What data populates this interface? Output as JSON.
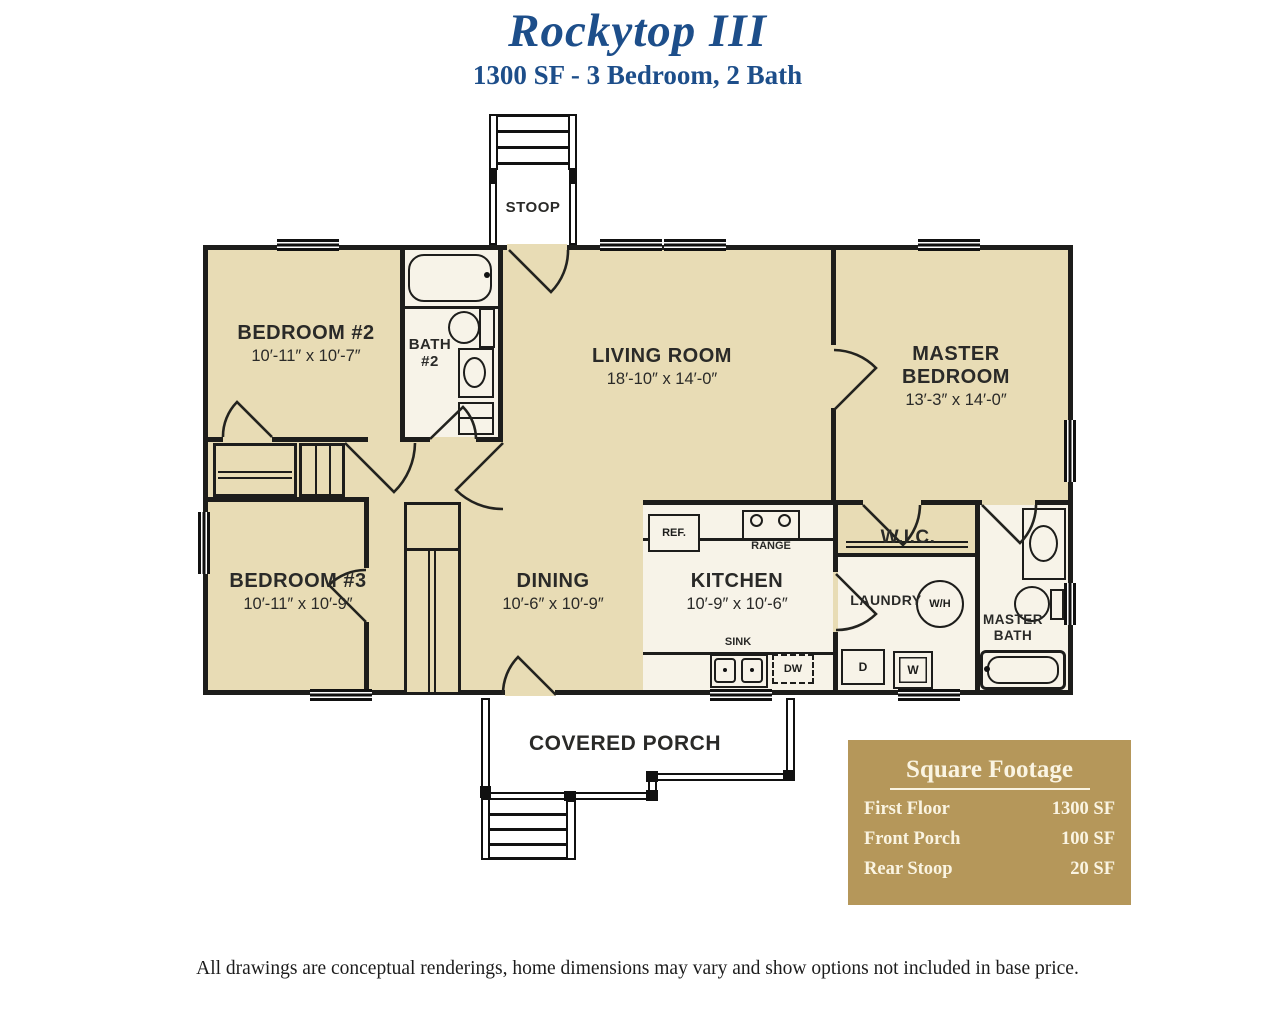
{
  "header": {
    "title": "Rockytop III",
    "subtitle": "1300 SF - 3 Bedroom, 2 Bath"
  },
  "rooms": {
    "stoop": {
      "name": "STOOP"
    },
    "bedroom2": {
      "name": "BEDROOM #2",
      "dims": "10′-11″ x 10′-7″"
    },
    "bath2": {
      "name": "BATH #2"
    },
    "living": {
      "name": "LIVING ROOM",
      "dims": "18′-10″ x 14′-0″"
    },
    "master": {
      "name": "MASTER BEDROOM",
      "dims": "13′-3″ x 14′-0″"
    },
    "bedroom3": {
      "name": "BEDROOM #3",
      "dims": "10′-11″ x 10′-9″"
    },
    "dining": {
      "name": "DINING",
      "dims": "10′-6″ x 10′-9″"
    },
    "kitchen": {
      "name": "KITCHEN",
      "dims": "10′-9″ x 10′-6″"
    },
    "wic": {
      "name": "W.I.C."
    },
    "laundry": {
      "name": "LAUNDRY"
    },
    "master_bath": {
      "name": "MASTER BATH"
    },
    "porch": {
      "name": "COVERED PORCH"
    }
  },
  "fixtures": {
    "ref": "REF.",
    "range": "RANGE",
    "sink": "SINK",
    "dishwasher": "DW",
    "dryer": "D",
    "washer": "W",
    "water_heater": "W/H"
  },
  "square_footage": {
    "title": "Square Footage",
    "rows": [
      {
        "label": "First Floor",
        "value": "1300 SF"
      },
      {
        "label": "Front Porch",
        "value": "100 SF"
      },
      {
        "label": "Rear Stoop",
        "value": "20 SF"
      }
    ]
  },
  "disclaimer": "All drawings are conceptual renderings, home dimensions may vary and show options not included in base price.",
  "colors": {
    "accent_blue": "#1d4e8a",
    "room_tan": "#e8dcb5",
    "room_light": "#f7f3e8",
    "wall": "#1d1d1b",
    "gold_panel": "#b5975a"
  }
}
